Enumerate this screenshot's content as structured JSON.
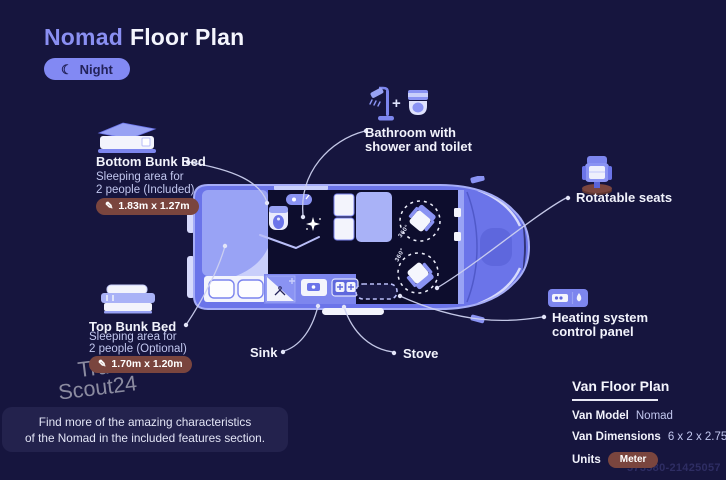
{
  "page": {
    "title_accent": "Nomad",
    "title_rest": "Floor Plan",
    "mode_badge": "Night",
    "ref_number": "573580-21425057"
  },
  "watermark": {
    "line1": "Truck",
    "line2": "Scout24"
  },
  "annotations": {
    "bottom_bunk": {
      "title": "Bottom Bunk Bed",
      "desc1": "Sleeping area for",
      "desc2": "2 people (Included)",
      "dimensions": "1.83m x 1.27m"
    },
    "top_bunk": {
      "title": "Top Bunk Bed",
      "desc1": "Sleeping area for",
      "desc2": "2 people (Optional)",
      "dimensions": "1.70m x 1.20m"
    },
    "bathroom": {
      "line1": "Bathroom with",
      "line2": "shower and toilet"
    },
    "rotatable_seats": "Rotatable seats",
    "heating": {
      "line1": "Heating system",
      "line2": "control panel"
    },
    "sink": "Sink",
    "stove": "Stove",
    "seat_rotation": "360°"
  },
  "info_panel": {
    "title": "Van Floor Plan",
    "model_label": "Van Model",
    "model_value": "Nomad",
    "dimensions_label": "Van Dimensions",
    "dimensions_value": "6 x 2 x 2.75 m",
    "units_label": "Units",
    "units_value": "Meter"
  },
  "footer": {
    "line1": "Find more of the amazing characteristics",
    "line2": "of the Nomad in the included features section."
  },
  "colors": {
    "background": "#16153e",
    "accent": "#8289f2",
    "van_fill": "#6b74e9",
    "dimension_pill": "#7a453e",
    "panel_bg": "#23224d"
  }
}
